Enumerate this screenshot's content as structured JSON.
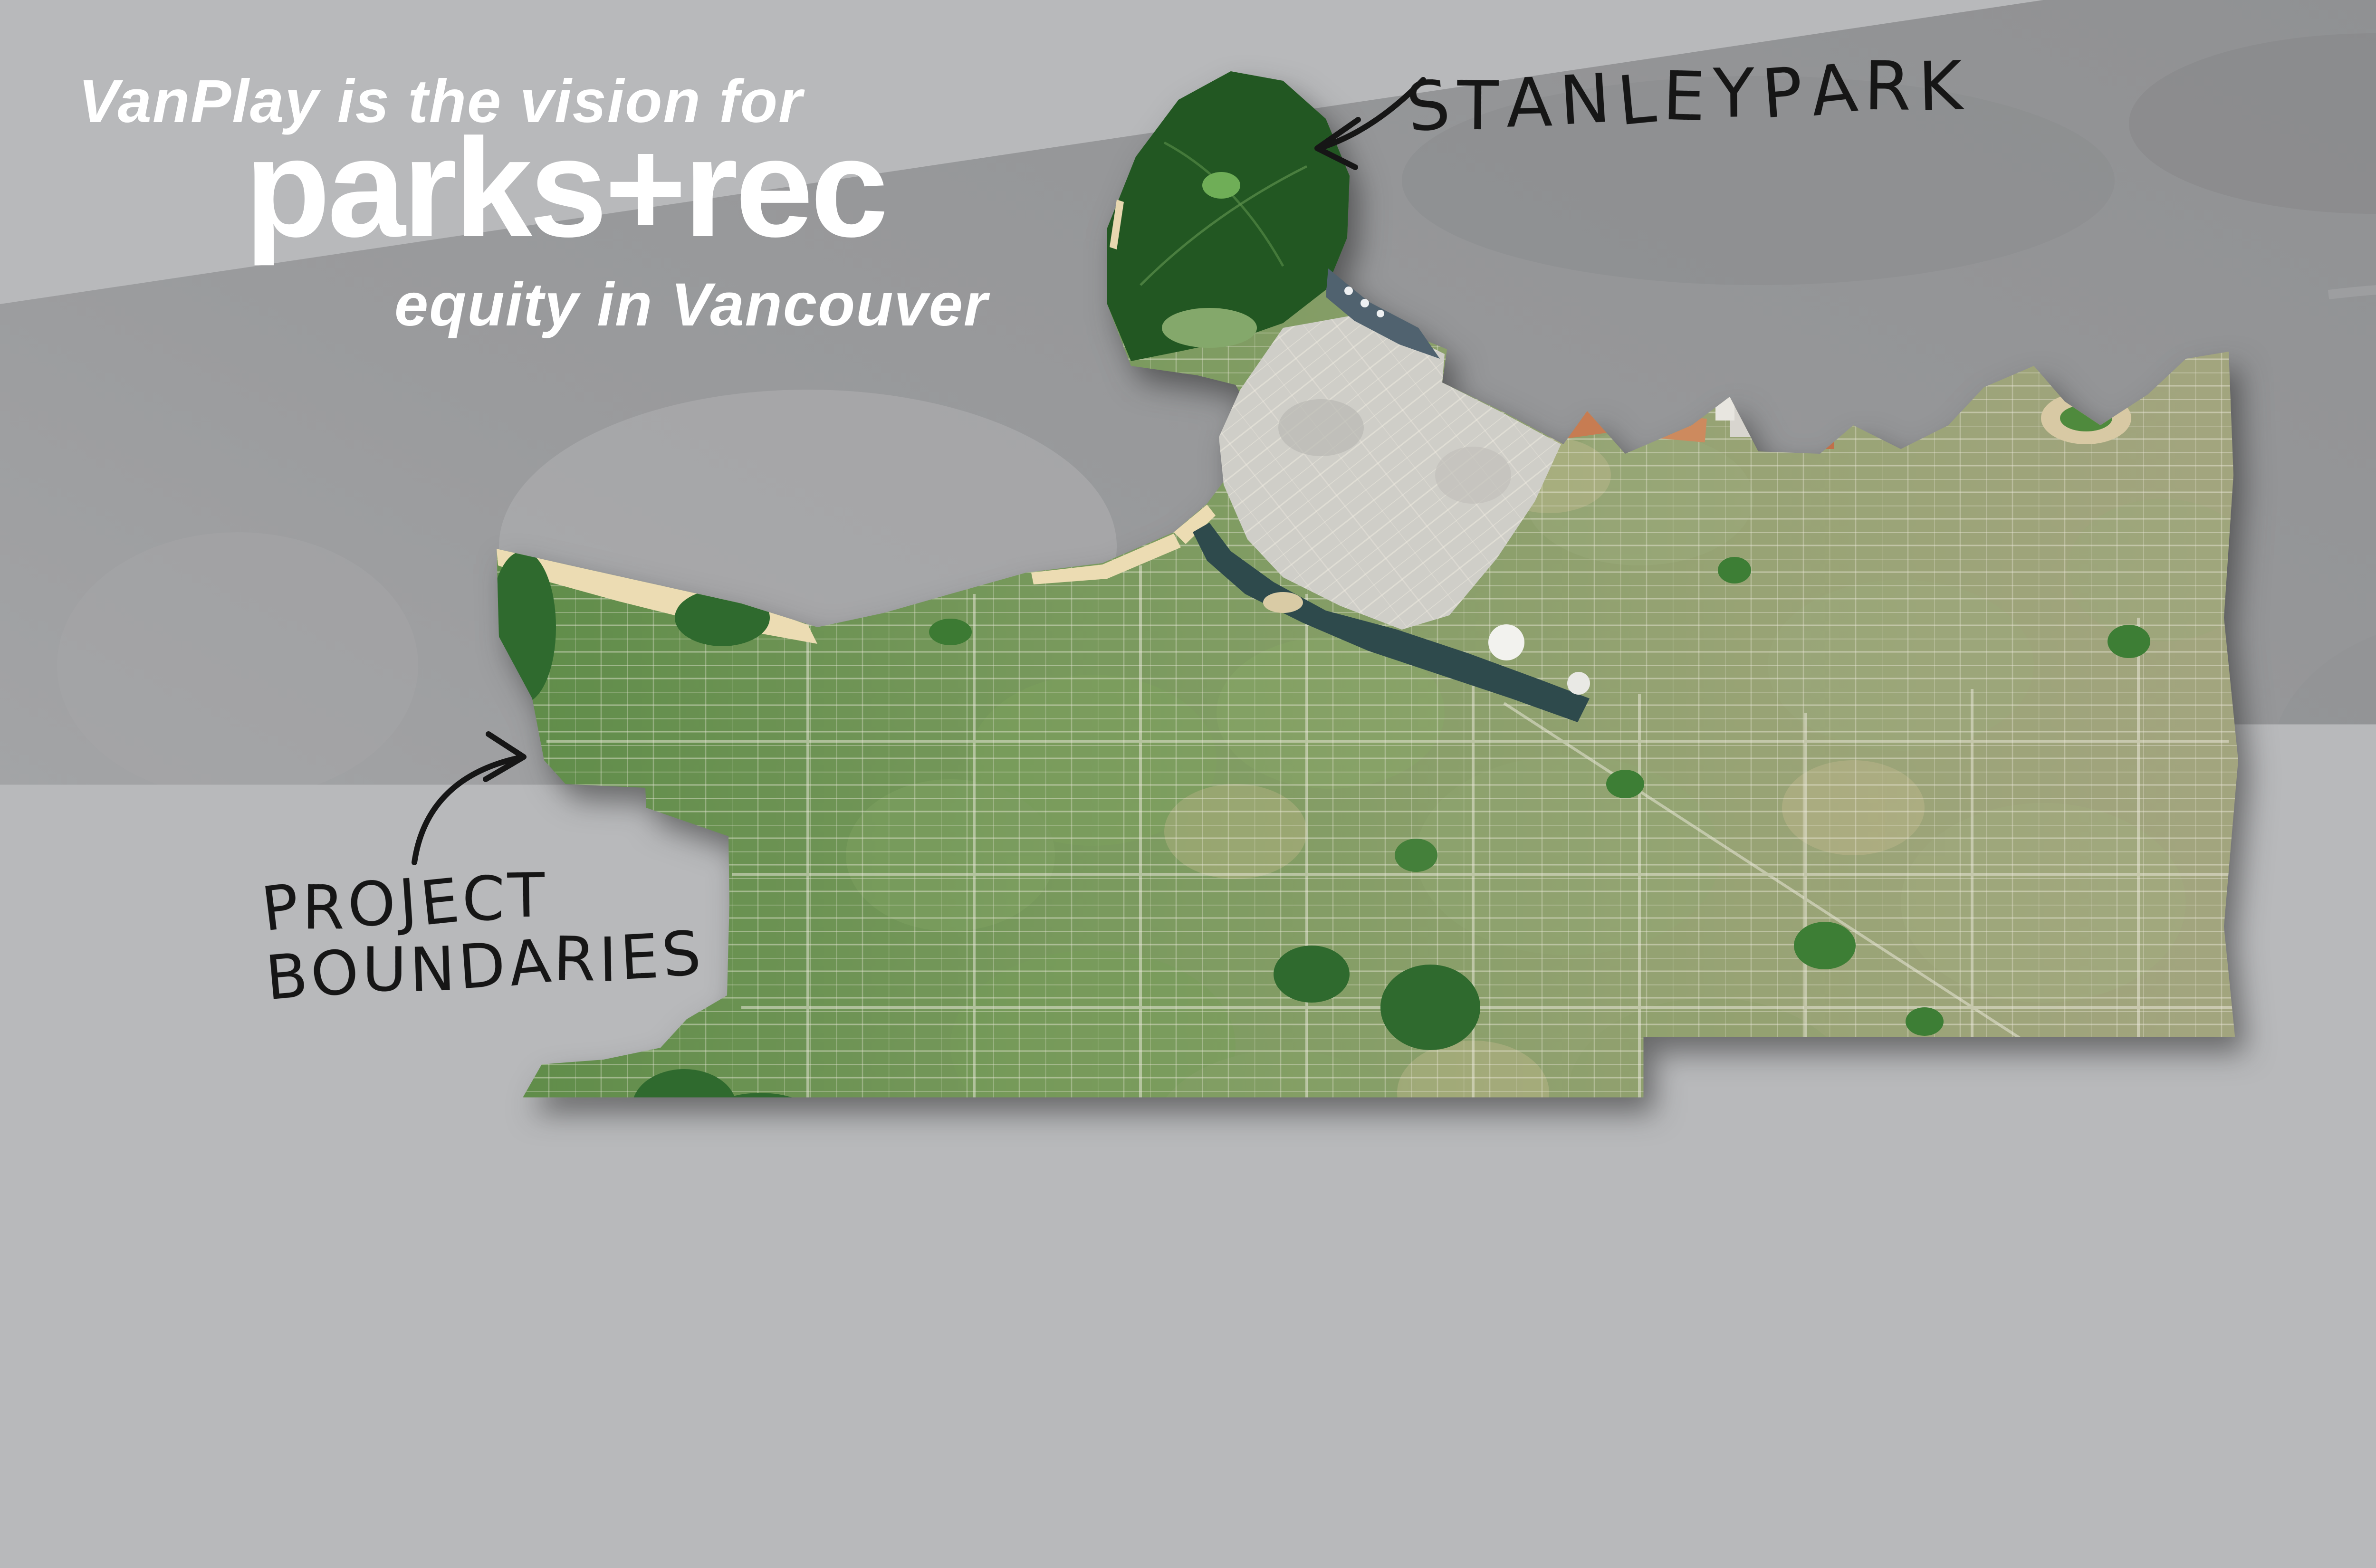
{
  "poster": {
    "title": {
      "line1": "VanPlay is the vision for",
      "line2": "parks+rec",
      "line3": "equity in Vancouver",
      "text_color": "#ffffff"
    },
    "map_annotations": {
      "stanley_park_label": "STANLEY PARK",
      "project_boundaries_label": "PROJECT\nBOUNDARIES"
    },
    "compass": {
      "north_label": "N"
    },
    "stats": [
      {
        "value": "1,300",
        "caption": "HECTARES OF PARKLAND\n& 440,000 TREES",
        "circle_color": "#ED6A4E",
        "text_color": "#ffffff"
      },
      {
        "value": "28",
        "caption": "KILOMETERS OF SEAWALL\n& 63% OF PARKS ADJACENT\nTO BIKEWAY OR GREENWAY",
        "circle_color": "#F9BA42",
        "text_color": "#ffffff"
      },
      {
        "value": "175",
        "caption": "RECREATION FACILITIES\nINCLUDING 24\nCOMMUNITY CENTRES",
        "circle_color": "#ED6A4E",
        "text_color": "#ffffff"
      }
    ],
    "colors": {
      "background_light_gray": "#b8b9bb",
      "faded_satellite_band": "#98999b",
      "annotation_ink": "#161616"
    }
  }
}
